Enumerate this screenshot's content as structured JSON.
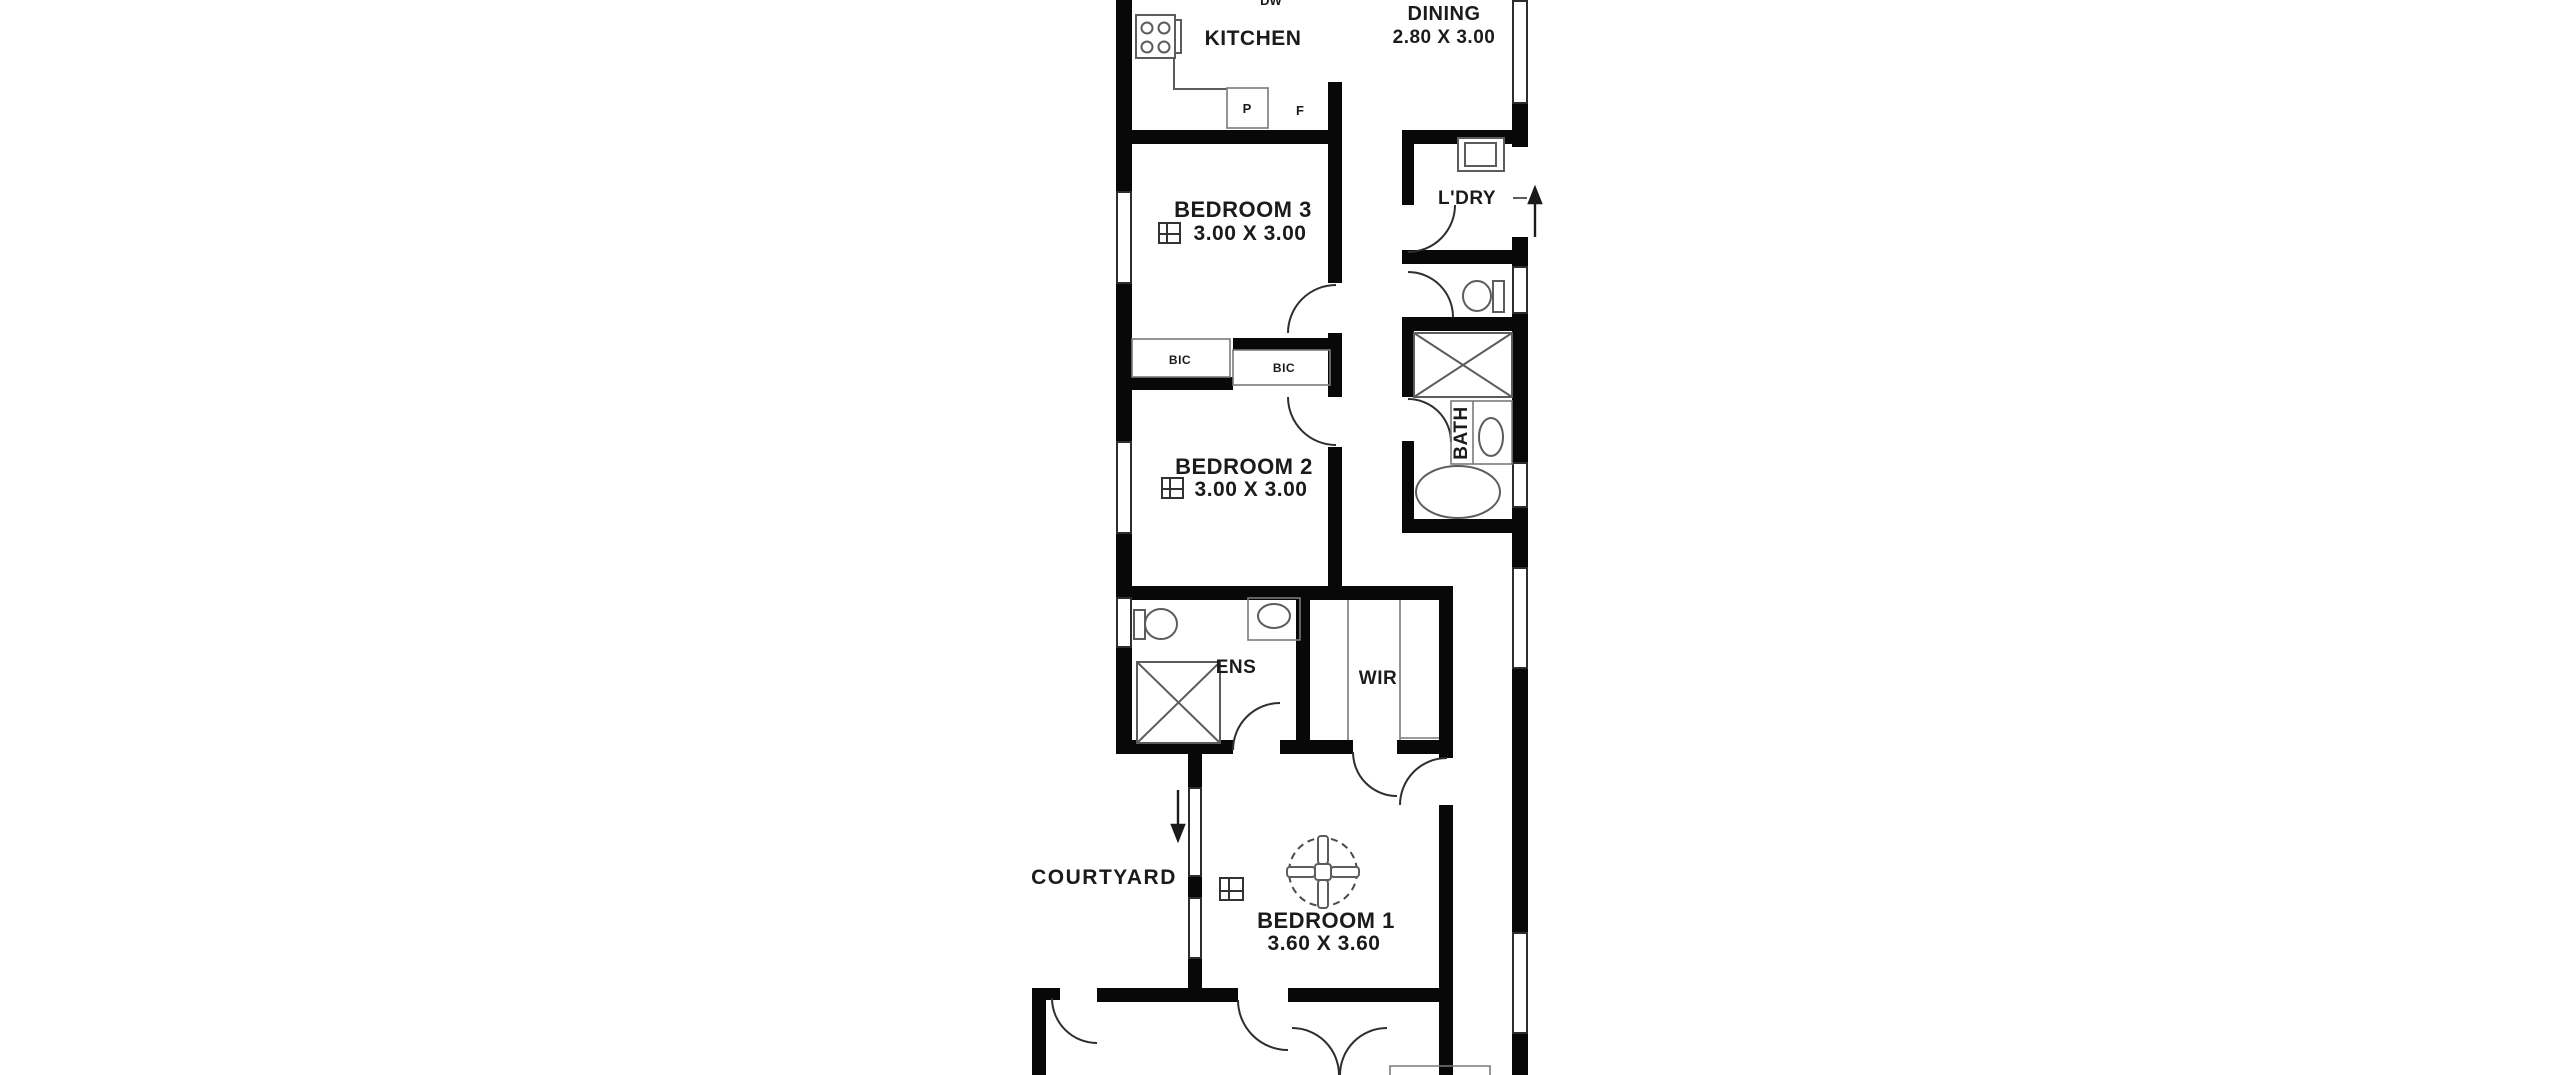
{
  "floorplan": {
    "background": "#ffffff",
    "wall_color": "#080808",
    "fixture_line_color": "#5c5c5c",
    "text_color": "#1b1b1b",
    "labels": {
      "kitchen": "KITCHEN",
      "dining": "DINING",
      "dining_dims": "2.80 X 3.00",
      "bedroom3": "BEDROOM 3",
      "bedroom3_dims": "3.00 X 3.00",
      "laundry": "L'DRY",
      "bath": "BATH",
      "bedroom2": "BEDROOM 2",
      "bedroom2_dims": "3.00 X 3.00",
      "bic_left": "BIC",
      "bic_right": "BIC",
      "ensuite": "ENS",
      "wardrobe": "WIR",
      "courtyard": "COURTYARD",
      "bedroom1": "BEDROOM 1",
      "bedroom1_dims": "3.60 X 3.60",
      "pantry": "P",
      "fridge": "F",
      "dishwasher": "DW"
    }
  }
}
